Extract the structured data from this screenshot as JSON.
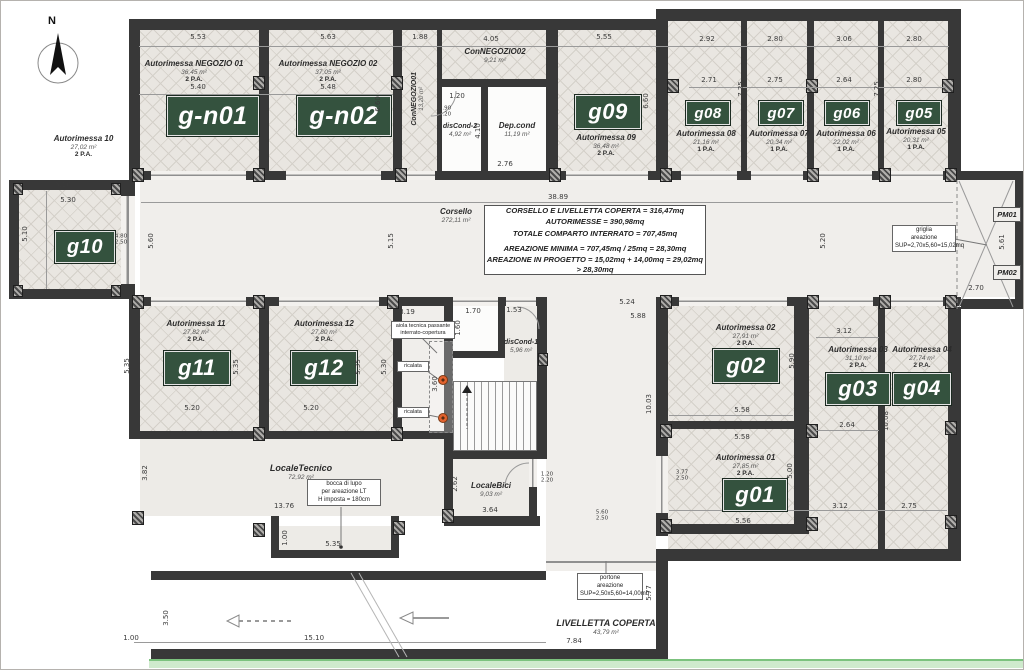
{
  "compass": {
    "label": "N"
  },
  "rooms": {
    "gn01": {
      "name": "Autorimessa NEGOZIO 01",
      "area": "36,45 m²",
      "spots": "2 P.A.",
      "code": "g-n01"
    },
    "gn02": {
      "name": "Autorimessa NEGOZIO 02",
      "area": "37,05 m²",
      "spots": "2 P.A.",
      "code": "g-n02"
    },
    "g09": {
      "name": "Autorimessa 09",
      "area": "36,48 m²",
      "spots": "2 P.A.",
      "code": "g09"
    },
    "g08": {
      "name": "Autorimessa 08",
      "area": "21,16 m²",
      "spots": "1 P.A.",
      "code": "g08"
    },
    "g07": {
      "name": "Autorimessa 07",
      "area": "20,34 m²",
      "spots": "1 P.A.",
      "code": "g07"
    },
    "g06": {
      "name": "Autorimessa 06",
      "area": "22,02 m²",
      "spots": "1 P.A.",
      "code": "g06"
    },
    "g05": {
      "name": "Autorimessa 05",
      "area": "20,31 m²",
      "spots": "1 P.A.",
      "code": "g05"
    },
    "g10": {
      "name": "Autorimessa 10",
      "area": "27,02 m²",
      "spots": "2 P.A.",
      "code": "g10"
    },
    "g11": {
      "name": "Autorimessa 11",
      "area": "27,82 m²",
      "spots": "2 P.A.",
      "code": "g11"
    },
    "g12": {
      "name": "Autorimessa 12",
      "area": "27,80 m²",
      "spots": "2 P.A.",
      "code": "g12"
    },
    "g01": {
      "name": "Autorimessa 01",
      "area": "27,85 m²",
      "spots": "2 P.A.",
      "code": "g01"
    },
    "g02": {
      "name": "Autorimessa 02",
      "area": "27,91 m²",
      "spots": "2 P.A.",
      "code": "g02"
    },
    "g03": {
      "name": "Autorimessa 03",
      "area": "31,10 m²",
      "spots": "2 P.A.",
      "code": "g03"
    },
    "g04": {
      "name": "Autorimessa 04",
      "area": "27,74 m²",
      "spots": "2 P.A.",
      "code": "g04"
    },
    "corsello": {
      "name": "Corsello",
      "area": "272,11 m²"
    },
    "connegozio01": {
      "name": "ConNEGOZIO01",
      "area": "13,20 m²"
    },
    "connegozio02": {
      "name": "ConNEGOZIO02",
      "area": "9,21 m²"
    },
    "depcond": {
      "name": "Dep.cond",
      "area": "11,19 m²"
    },
    "discond2": {
      "name": "disCond-2",
      "area": "4,92 m²"
    },
    "discond1": {
      "name": "disCond-1",
      "area": "5,96 m²"
    },
    "localetecnico": {
      "name": "LocaleTecnico",
      "area": "72,92 m²"
    },
    "localebici": {
      "name": "LocaleBici",
      "area": "9,03 m²"
    },
    "livelletta": {
      "name": "LIVELLETTA COPERTA",
      "area": "43,79 m²"
    },
    "pm01": {
      "code": "PM01"
    },
    "pm02": {
      "code": "PM02"
    }
  },
  "summary": {
    "lines": [
      "CORSELLO E LIVELLETTA COPERTA = 316,47mq",
      "AUTORIMESSE = 390,98mq",
      "TOTALE COMPARTO INTERRATO = 707,45mq",
      "AREAZIONE MINIMA = 707,45mq / 25mq = 28,30mq",
      "AREAZIONE IN PROGETTO = 15,02mq + 14,00mq = 29,02mq > 28,30mq"
    ]
  },
  "notes": {
    "griglia": "griglia\nareazione\nSUP=2,70x5,60=15,02mq",
    "portone": "portone\nareazione\nSUP=2,50x5,60=14,00mq",
    "bocca": "bocca di lupo\nper areazione LT\nH imposta = 180cm",
    "aiola": "aiola tecnica passante\ninterrato-copertura",
    "ricalata": "ricalata"
  },
  "dims": [
    "5.53",
    "5.63",
    "1.88",
    "4.05",
    "5.55",
    "2.92",
    "2.80",
    "3.06",
    "2.80",
    "5.40",
    "5.48",
    "2.71",
    "2.75",
    "2.64",
    "2.80",
    "6.60",
    "6.60",
    "7.25",
    "7.25",
    "1.20",
    "0.90\n2.20",
    "4.10",
    "2.76",
    "5.10",
    "5.30",
    "5.10",
    "4.80\n2.50",
    "38.89",
    "5.60",
    "5.15",
    "5.20",
    "2.70",
    "5.61",
    "5.24",
    "5.88",
    "3.19",
    "1.70",
    "1.53",
    "1.60",
    "0.91",
    "3.60",
    "5.35",
    "5.20",
    "5.35",
    "5.20",
    "5.35",
    "5.30",
    "10.03",
    "5.58",
    "5.90",
    "3.12",
    "2.64",
    "10.08",
    "5.58",
    "3.77\n2.50",
    "5.00",
    "5.56",
    "3.12",
    "2.75",
    "3.82",
    "13.76",
    "1.00",
    "5.35",
    "2.62",
    "3.64",
    "1.20\n2.20",
    "5.60\n2.50",
    "5.77",
    "7.84",
    "3.50",
    "1.00",
    "15.10"
  ]
}
